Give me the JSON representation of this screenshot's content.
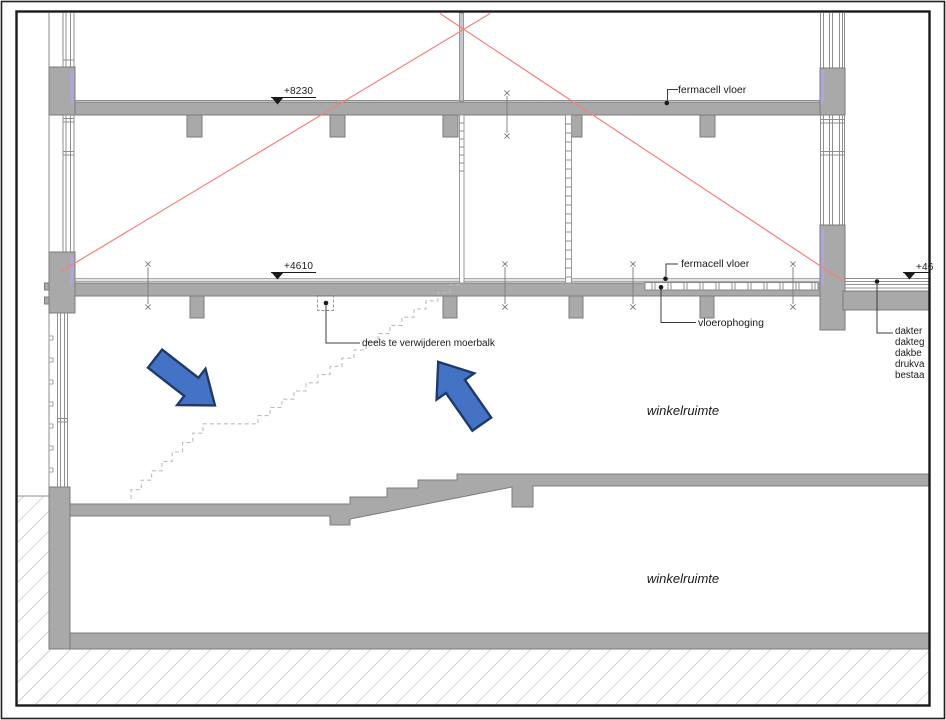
{
  "annotations": {
    "level_8230": "+8230",
    "level_4610": "+4610",
    "level_46_partial": "+46",
    "fermacell_upper": "fermacell vloer",
    "fermacell_lower": "fermacell vloer",
    "vloerophoging": "vloerophoging",
    "moerbalk_note": "deels te verwijderen moerbalk",
    "room_first_floor": "winkelruimte",
    "room_ground_floor": "winkelruimte",
    "roof_notes": [
      "dakter",
      "dakteg",
      "dakbe",
      "drukva",
      "bestaa"
    ]
  },
  "colors": {
    "structure_gray": "#a9a9a9",
    "structure_outline": "#7c7c7c",
    "window_line": "#8f8f8f",
    "insulation_purple": "#b1a4d8",
    "demolition_red": "#f2837b",
    "stair_dash_gray": "#bdbdbd",
    "hatch_gray": "#cfcfcf",
    "arrow_blue": "#4472c4",
    "arrow_border": "#1f3a68",
    "leader_gray": "#3c3c3c",
    "text_black": "#1a1a1a"
  }
}
